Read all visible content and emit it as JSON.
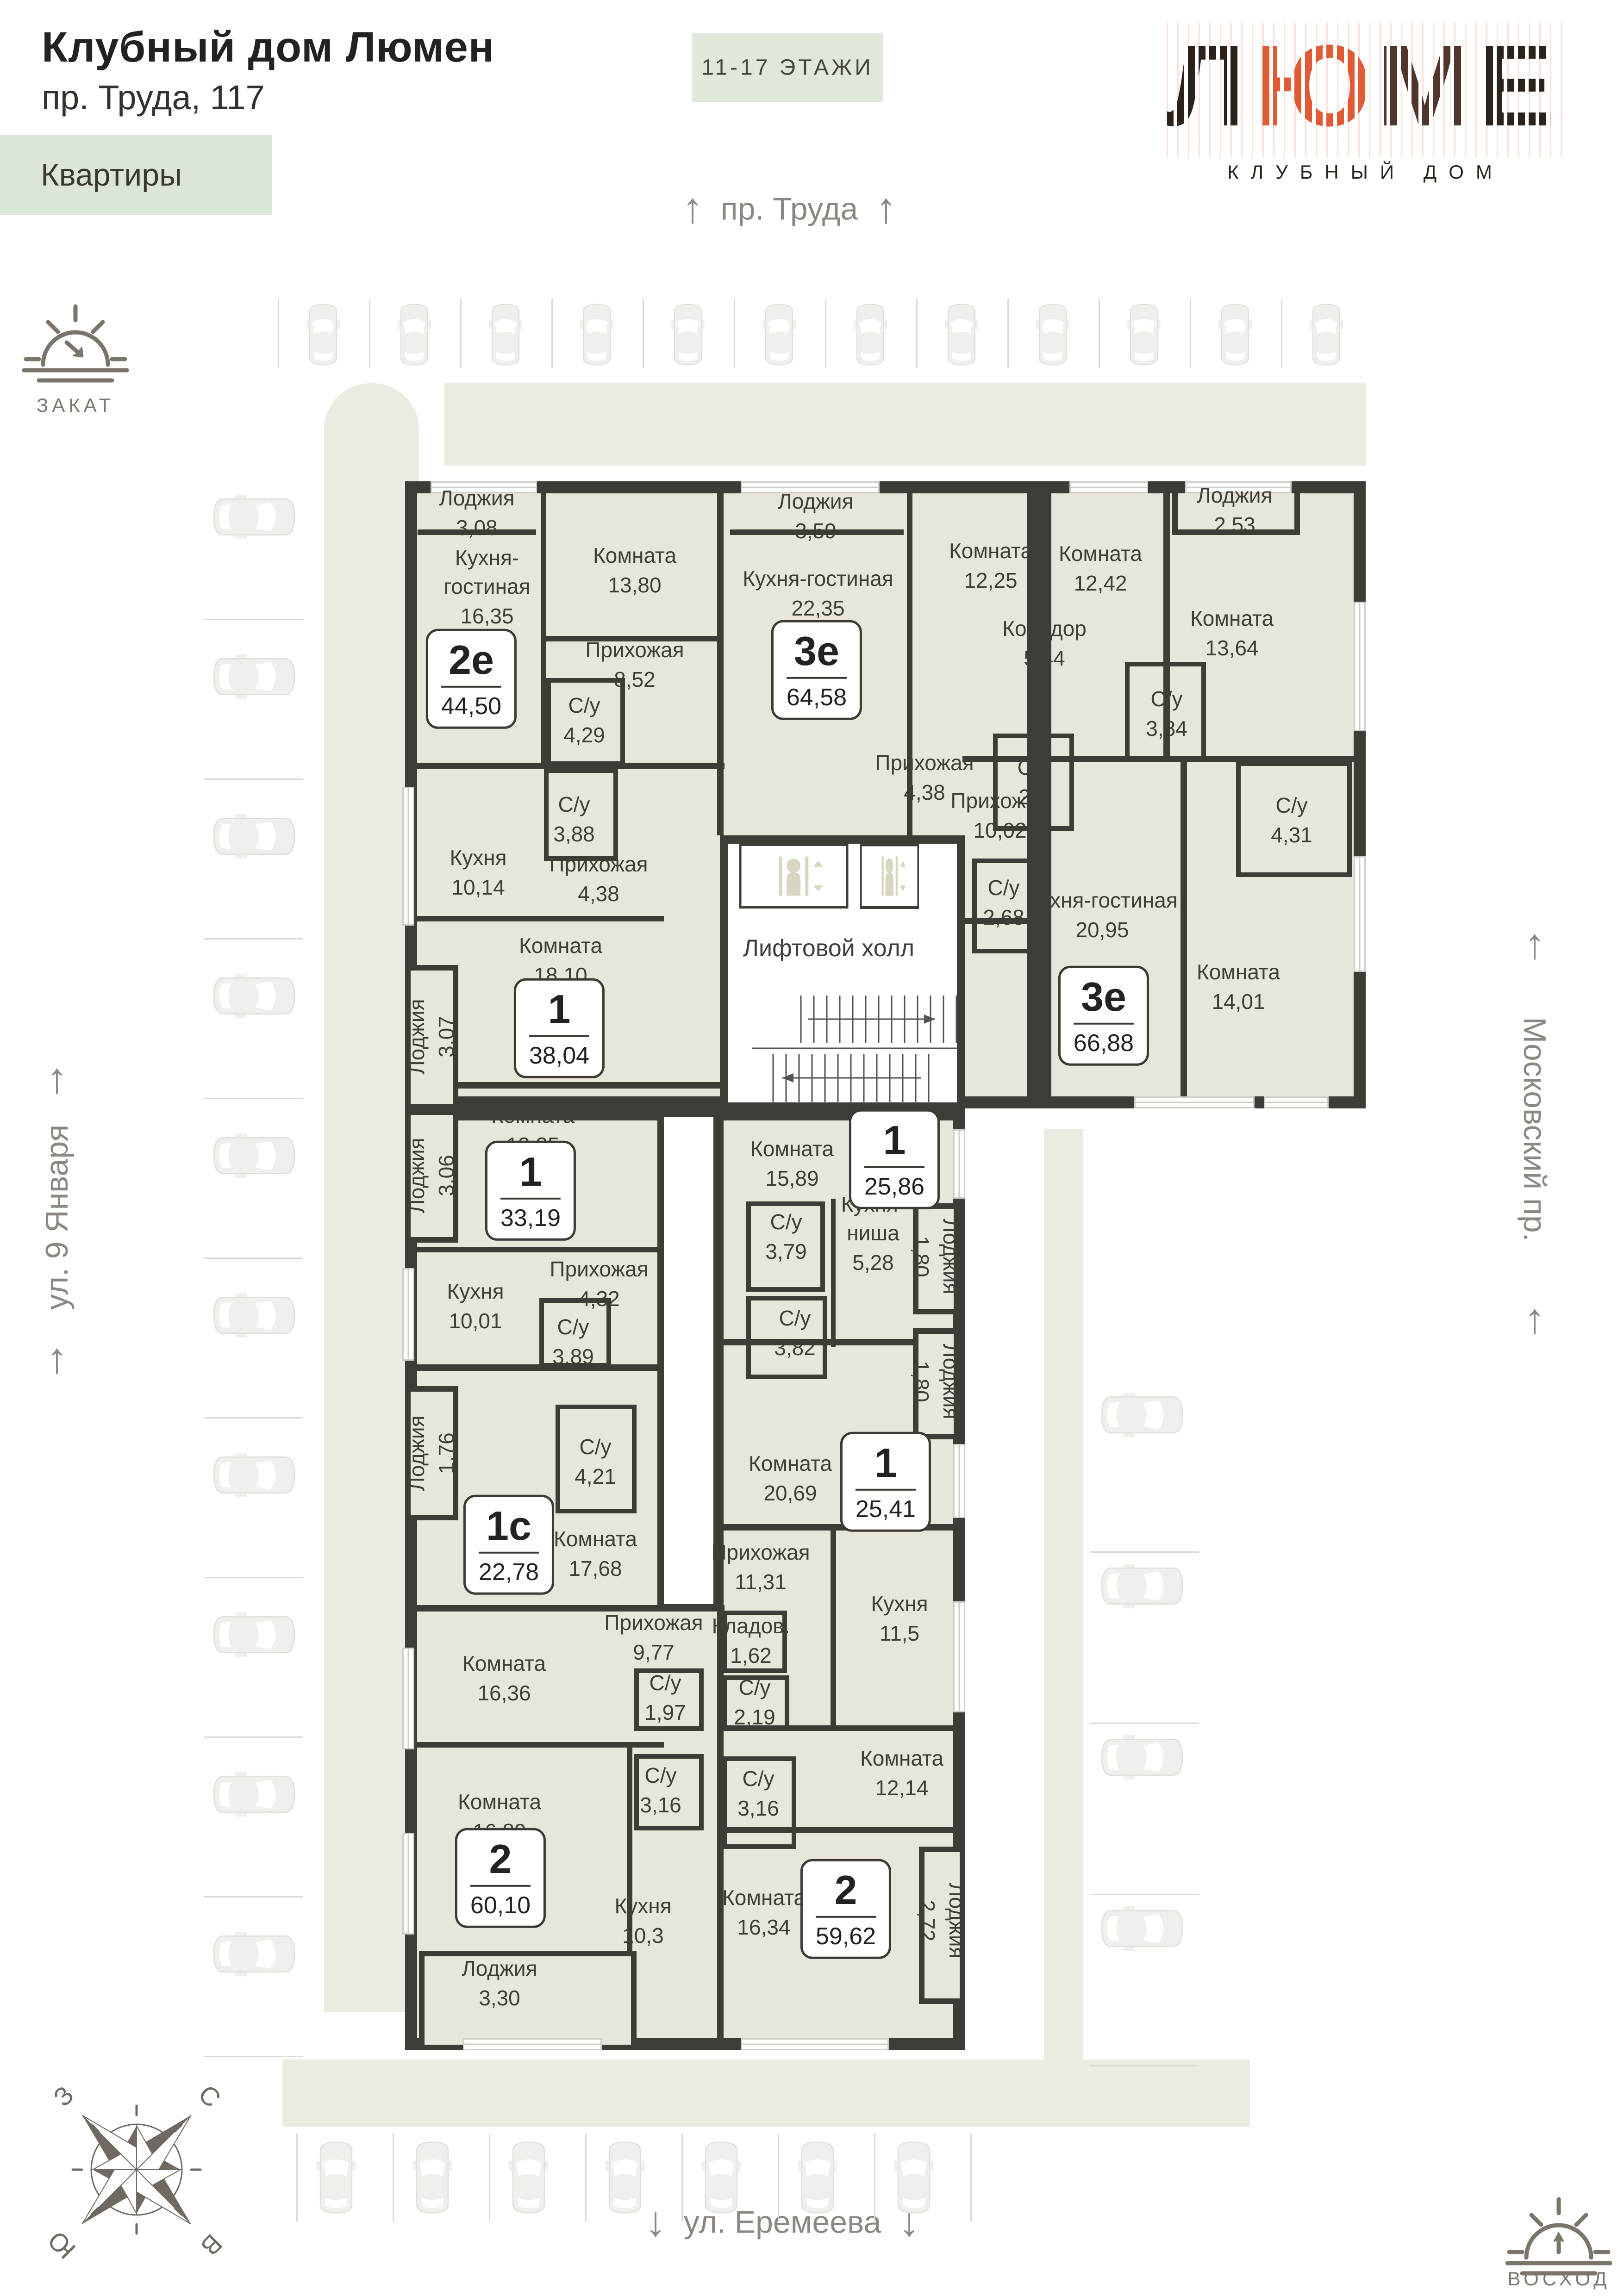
{
  "header": {
    "title": "Клубный дом Люмен",
    "address": "пр. Труда, 117",
    "section_label": "Квартиры",
    "floors_badge": "11-17 ЭТАЖИ"
  },
  "logo": {
    "letters": [
      "Л",
      "Ю",
      "М",
      "Е",
      "Н"
    ],
    "subtitle": "КЛУБНЫЙ ДОМ",
    "color_dark": "#2b221c",
    "color_accent": "#e05a35",
    "color_brown": "#4f352a"
  },
  "streets": {
    "top": "пр. Труда",
    "bottom": "ул. Еремеева",
    "left": "ул. 9 Января",
    "right": "Московский пр."
  },
  "icons": {
    "arrow_up": "↑",
    "arrow_down": "↓"
  },
  "orientation": {
    "sunset_label": "ЗАКАТ",
    "sunrise_label": "ВОСХОД",
    "compass": {
      "n": "С",
      "e": "В",
      "s": "Ю",
      "w": "З"
    }
  },
  "common_areas": {
    "lift_hall": "Лифтовой холл"
  },
  "apartments": [
    {
      "type": "2е",
      "area": "44,50",
      "rooms": [
        {
          "name": "Лоджия",
          "area": "3,08"
        },
        {
          "name": "Кухня-гостиная",
          "area": "16,35"
        },
        {
          "name": "Комната",
          "area": "13,80"
        },
        {
          "name": "Прихожая",
          "area": "8,52"
        },
        {
          "name": "С/у",
          "area": "4,29"
        }
      ]
    },
    {
      "type": "3е",
      "area": "64,58",
      "rooms": [
        {
          "name": "Лоджия",
          "area": "3,59"
        },
        {
          "name": "Кухня-гостиная",
          "area": "22,35"
        },
        {
          "name": "Комната",
          "area": "12,25"
        },
        {
          "name": "Комната",
          "area": "12,42"
        },
        {
          "name": "Коридор",
          "area": "5,44"
        },
        {
          "name": "Прихожая",
          "area": "4,38"
        },
        {
          "name": "С/у",
          "area": "2,1"
        },
        {
          "name": "С/у",
          "area": "3,84"
        }
      ]
    },
    {
      "type": "3е",
      "area": "66,88",
      "rooms": [
        {
          "name": "Лоджия",
          "area": "2,53"
        },
        {
          "name": "Комната",
          "area": "13,64"
        },
        {
          "name": "С/у",
          "area": "4,31"
        },
        {
          "name": "Прихожая",
          "area": "10,02"
        },
        {
          "name": "С/у",
          "area": "2,68"
        },
        {
          "name": "Кухня-гостиная",
          "area": "20,95"
        },
        {
          "name": "Комната",
          "area": "14,01"
        }
      ]
    },
    {
      "type": "1",
      "area": "38,04",
      "rooms": [
        {
          "name": "Кухня",
          "area": "10,14"
        },
        {
          "name": "С/у",
          "area": "3,88"
        },
        {
          "name": "Прихожая",
          "area": "4,38"
        },
        {
          "name": "Комната",
          "area": "18,10"
        },
        {
          "name": "Лоджия",
          "area": "3,07"
        }
      ]
    },
    {
      "type": "1",
      "area": "33,19",
      "rooms": [
        {
          "name": "Комната",
          "area": "13,35"
        },
        {
          "name": "Лоджия",
          "area": "3,06"
        },
        {
          "name": "Кухня",
          "area": "10,01"
        },
        {
          "name": "Прихожая",
          "area": "4,32"
        },
        {
          "name": "С/у",
          "area": "3,89"
        }
      ]
    },
    {
      "type": "1",
      "area": "25,86",
      "rooms": [
        {
          "name": "Комната",
          "area": "15,89"
        },
        {
          "name": "С/у",
          "area": "3,79"
        },
        {
          "name": "Кухня-ниша",
          "area": "5,28"
        },
        {
          "name": "Лоджия",
          "area": "1,80"
        }
      ]
    },
    {
      "type": "1",
      "area": "25,41",
      "rooms": [
        {
          "name": "Комната",
          "area": "20,69"
        },
        {
          "name": "С/у",
          "area": "3,82"
        },
        {
          "name": "Лоджия",
          "area": "1,80"
        }
      ]
    },
    {
      "type": "1с",
      "area": "22,78",
      "rooms": [
        {
          "name": "Лоджия",
          "area": "1,76"
        },
        {
          "name": "С/у",
          "area": "4,21"
        },
        {
          "name": "Комната",
          "area": "17,68"
        }
      ]
    },
    {
      "type": "2",
      "area": "60,10",
      "rooms": [
        {
          "name": "Комната",
          "area": "16,36"
        },
        {
          "name": "Прихожая",
          "area": "9,77"
        },
        {
          "name": "С/у",
          "area": "1,97"
        },
        {
          "name": "Комната",
          "area": "16,89"
        },
        {
          "name": "С/у",
          "area": "3,16"
        },
        {
          "name": "Кухня",
          "area": "10,3"
        },
        {
          "name": "Лоджия",
          "area": "3,30"
        }
      ]
    },
    {
      "type": "2",
      "area": "59,62",
      "rooms": [
        {
          "name": "Прихожая",
          "area": "11,31"
        },
        {
          "name": "Кладов.",
          "area": "1,62"
        },
        {
          "name": "С/у",
          "area": "2,19"
        },
        {
          "name": "Кухня",
          "area": "11,5"
        },
        {
          "name": "С/у",
          "area": "3,16"
        },
        {
          "name": "Комната",
          "area": "12,14"
        },
        {
          "name": "Комната",
          "area": "16,34"
        },
        {
          "name": "Лоджия",
          "area": "2,72"
        }
      ]
    }
  ]
}
